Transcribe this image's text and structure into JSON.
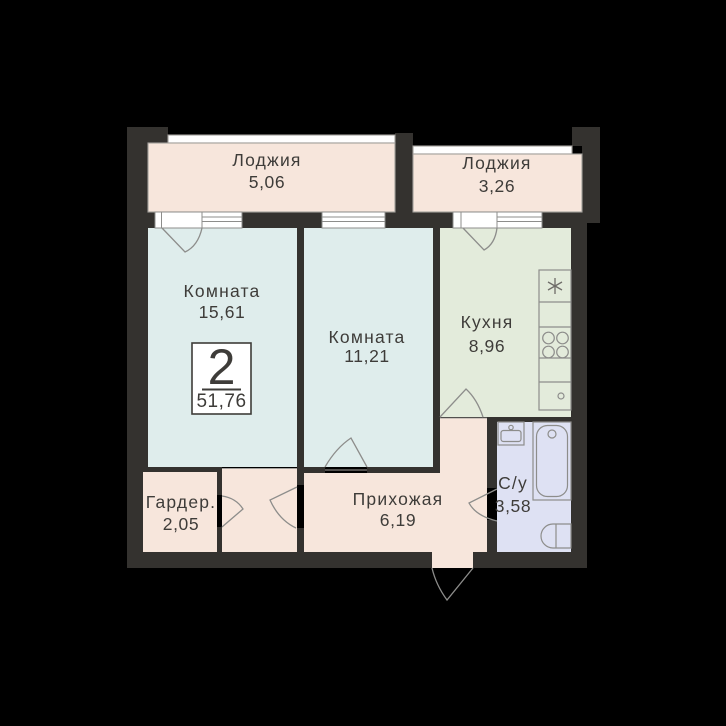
{
  "plan": {
    "title": "2-room apartment floor plan",
    "badge": {
      "rooms_count": "2",
      "total_area": "51,76"
    },
    "rooms": [
      {
        "id": "loggia-1",
        "name": "Лоджия",
        "area": "5,06"
      },
      {
        "id": "loggia-2",
        "name": "Лоджия",
        "area": "3,26"
      },
      {
        "id": "room-1",
        "name": "Комната",
        "area": "15,61"
      },
      {
        "id": "room-2",
        "name": "Комната",
        "area": "11,21"
      },
      {
        "id": "kitchen",
        "name": "Кухня",
        "area": "8,96"
      },
      {
        "id": "wardrobe",
        "name": "Гардер.",
        "area": "2,05"
      },
      {
        "id": "hallway",
        "name": "Прихожая",
        "area": "6,19"
      },
      {
        "id": "bathroom",
        "name": "С/у",
        "area": "3,58"
      }
    ],
    "colors": {
      "background": "#000000",
      "wall": "#34322f",
      "loggia_fill": "#f7e6dc",
      "hall_fill": "#f7e6dc",
      "room_fill": "#dfedec",
      "kitchen_fill": "#e3ebdb",
      "bath_fill": "#dee1f3",
      "counter_fill": "#eef2e8",
      "fixture_fill": "#e9ebf8",
      "text": "#3e3c39",
      "white": "#ffffff"
    }
  }
}
